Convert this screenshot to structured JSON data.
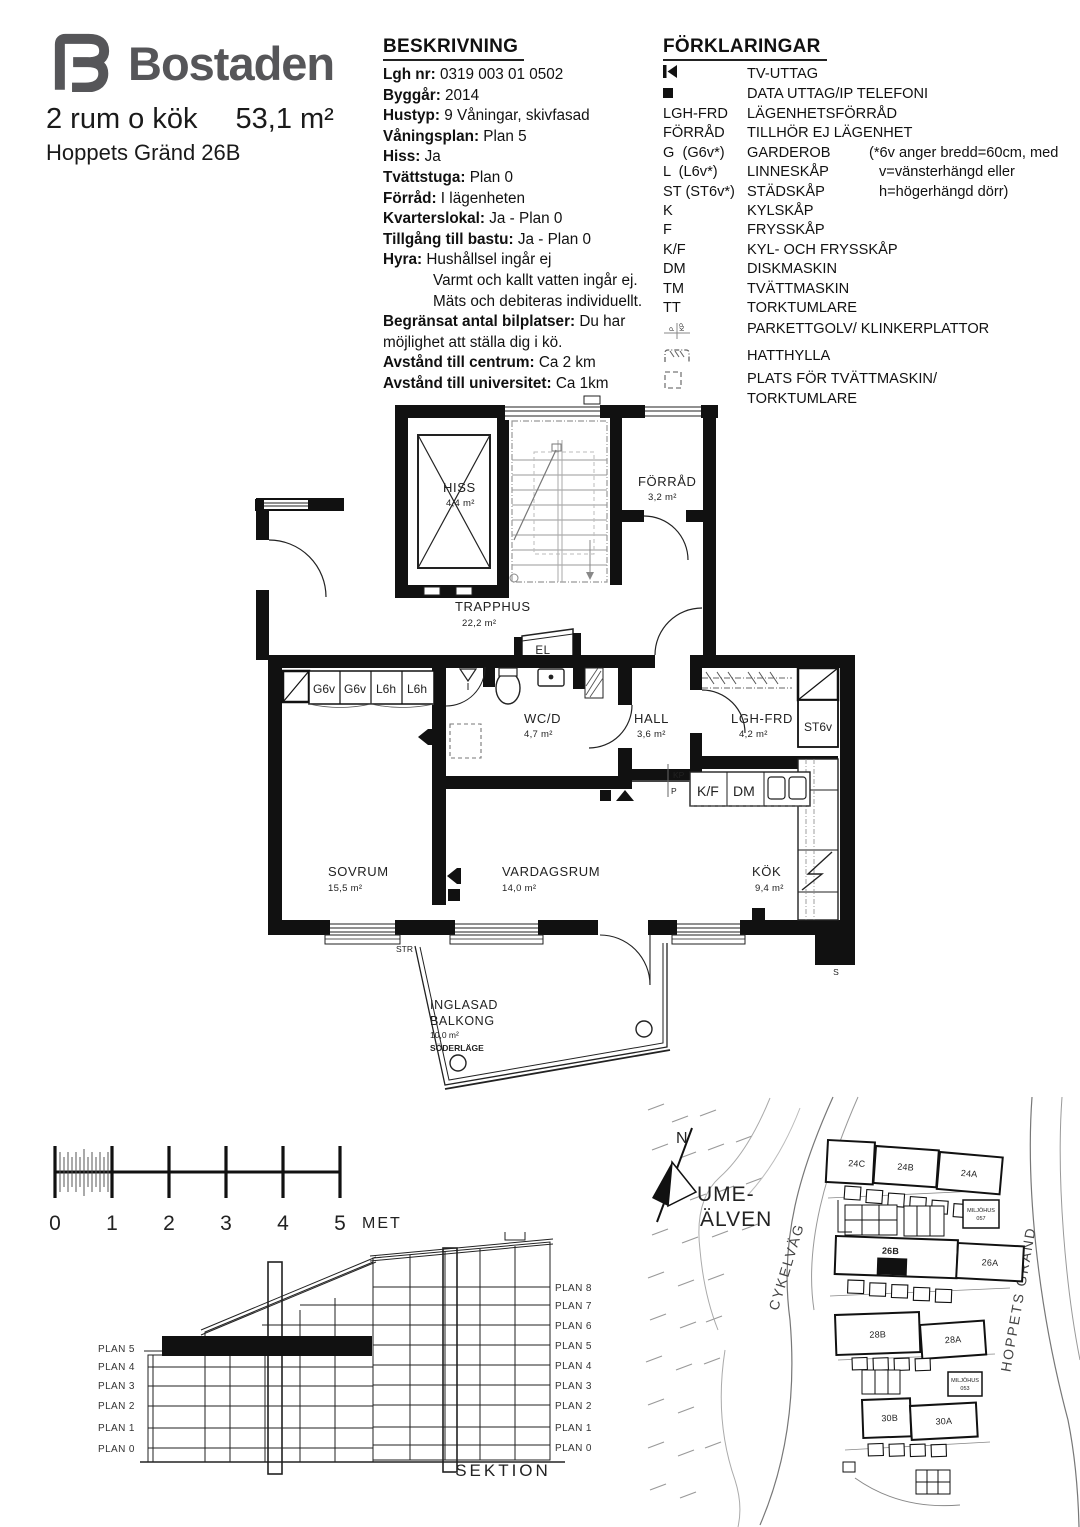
{
  "colors": {
    "ink": "#111111",
    "logo_gray": "#565659",
    "wall_black": "#111111"
  },
  "header": {
    "brand": "Bostaden",
    "apartment_type": "2 rum o kök",
    "area": "53,1 m²",
    "address": "Hoppets Gränd 26B"
  },
  "beskrivning": {
    "title": "BESKRIVNING",
    "rows": [
      {
        "label": "Lgh nr:",
        "value": "0319 003 01 0502"
      },
      {
        "label": "Byggår:",
        "value": "2014"
      },
      {
        "label": "Hustyp:",
        "value": "9 Våningar, skivfasad"
      },
      {
        "label": "Våningsplan:",
        "value": "Plan 5"
      },
      {
        "label": "Hiss:",
        "value": "Ja"
      },
      {
        "label": "Tvättstuga:",
        "value": "Plan 0"
      },
      {
        "label": "Förråd:",
        "value": "I lägenheten"
      },
      {
        "label": "Kvarterslokal:",
        "value": "Ja - Plan 0"
      },
      {
        "label": "Tillgång till bastu:",
        "value": "Ja - Plan 0"
      },
      {
        "label": "Hyra:",
        "value": "Hushållsel ingår ej"
      },
      {
        "label": "",
        "value": "Varmt och kallt vatten ingår ej."
      },
      {
        "label": "",
        "value": "Mäts och debiteras individuellt."
      },
      {
        "label": "Begränsat antal bilplatser:",
        "value": "Du har möjlighet att ställa dig i kö."
      },
      {
        "label": "Avstånd till centrum:",
        "value": "Ca 2 km"
      },
      {
        "label": "Avstånd till universitet:",
        "value": "Ca 1km"
      }
    ]
  },
  "forklaringar": {
    "title": "FÖRKLARINGAR",
    "rows": [
      {
        "icon": "tv-outlet-icon",
        "label": "TV-UTTAG"
      },
      {
        "icon": "data-outlet-icon",
        "label": "DATA UTTAG/IP TELEFONI"
      },
      {
        "key": "LGH-FRD",
        "label": "LÄGENHETSFÖRRÅD"
      },
      {
        "key": "FÖRRÅD",
        "label": "TILLHÖR EJ LÄGENHET"
      },
      {
        "key": "G  (G6v*)",
        "label": "GARDEROB",
        "note": "(*6v anger bredd=60cm, med"
      },
      {
        "key": "L  (L6v*)",
        "label": "LINNESKÅP",
        "note": "v=vänsterhängd eller"
      },
      {
        "key": "ST (ST6v*)",
        "label": "STÄDSKÅP",
        "note": "h=högerhängd dörr)"
      },
      {
        "key": "K",
        "label": "KYLSKÅP"
      },
      {
        "key": "F",
        "label": "FRYSSKÅP"
      },
      {
        "key": "K/F",
        "label": "KYL- OCH FRYSSKÅP"
      },
      {
        "key": "DM",
        "label": "DISKMASKIN"
      },
      {
        "key": "TM",
        "label": "TVÄTTMASKIN"
      },
      {
        "key": "TT",
        "label": "TORKTUMLARE"
      },
      {
        "icon": "floor-marker-icon",
        "label": "PARKETTGOLV/ KLINKERPLATTOR"
      },
      {
        "icon": "hat-shelf-icon",
        "label": "HATTHYLLA"
      },
      {
        "icon": "washer-place-icon",
        "label": "PLATS FÖR TVÄTTMASKIN/",
        "label2": "TORKTUMLARE"
      }
    ]
  },
  "floorplan": {
    "hiss": {
      "name": "HISS",
      "area": "4,4 m²"
    },
    "forrad": {
      "name": "FÖRRÅD",
      "area": "3,2 m²"
    },
    "trapphus": {
      "name": "TRAPPHUS",
      "area": "22,2 m²"
    },
    "el": "EL",
    "wcd": {
      "name": "WC/D",
      "area": "4,7 m²"
    },
    "hall": {
      "name": "HALL",
      "area": "3,6 m²"
    },
    "lghfrd": {
      "name": "LGH-FRD",
      "area": "4,2 m²"
    },
    "st6v": "ST6v",
    "sovrum": {
      "name": "SOVRUM",
      "area": "15,5 m²"
    },
    "vardagsrum": {
      "name": "VARDAGSRUM",
      "area": "14,0 m²"
    },
    "kok": {
      "name": "KÖK",
      "area": "9,4 m²"
    },
    "kf": "K/F",
    "dm": "DM",
    "balkong": {
      "line1": "INGLASAD",
      "line2": "BALKONG",
      "area": "10,0 m²",
      "line3": "SÖDERLÄGE"
    },
    "wardrobes": [
      "G6v",
      "G6v",
      "L6h",
      "L6h"
    ],
    "kp": "KP",
    "p": "P",
    "str": "STR",
    "s": "S"
  },
  "scalebar": {
    "ticks": [
      "0",
      "1",
      "2",
      "3",
      "4",
      "5"
    ],
    "unit": "METER"
  },
  "sektion": {
    "title": "SEKTION",
    "left": [
      "PLAN 5",
      "PLAN 4",
      "PLAN 3",
      "PLAN 2",
      "PLAN 1",
      "PLAN 0"
    ],
    "right": [
      "PLAN 8",
      "PLAN 7",
      "PLAN 6",
      "PLAN 5",
      "PLAN 4",
      "PLAN 3",
      "PLAN 2",
      "PLAN 1",
      "PLAN 0"
    ]
  },
  "sitemap": {
    "north": "N",
    "river1": "UME-",
    "river2": "ÄLVEN",
    "road_cykel": "CYKELVÄG",
    "road_hoppets": "HOPPETS GRÄND",
    "b24c": "24C",
    "b24b": "24B",
    "b24a": "24A",
    "b26b": "26B",
    "b26a": "26A",
    "b28b": "28B",
    "b28a": "28A",
    "b30b": "30B",
    "b30a": "30A",
    "mh1a": "MILJÖHUS",
    "mh1b": "057",
    "mh2a": "MILJÖHUS",
    "mh2b": "053"
  }
}
